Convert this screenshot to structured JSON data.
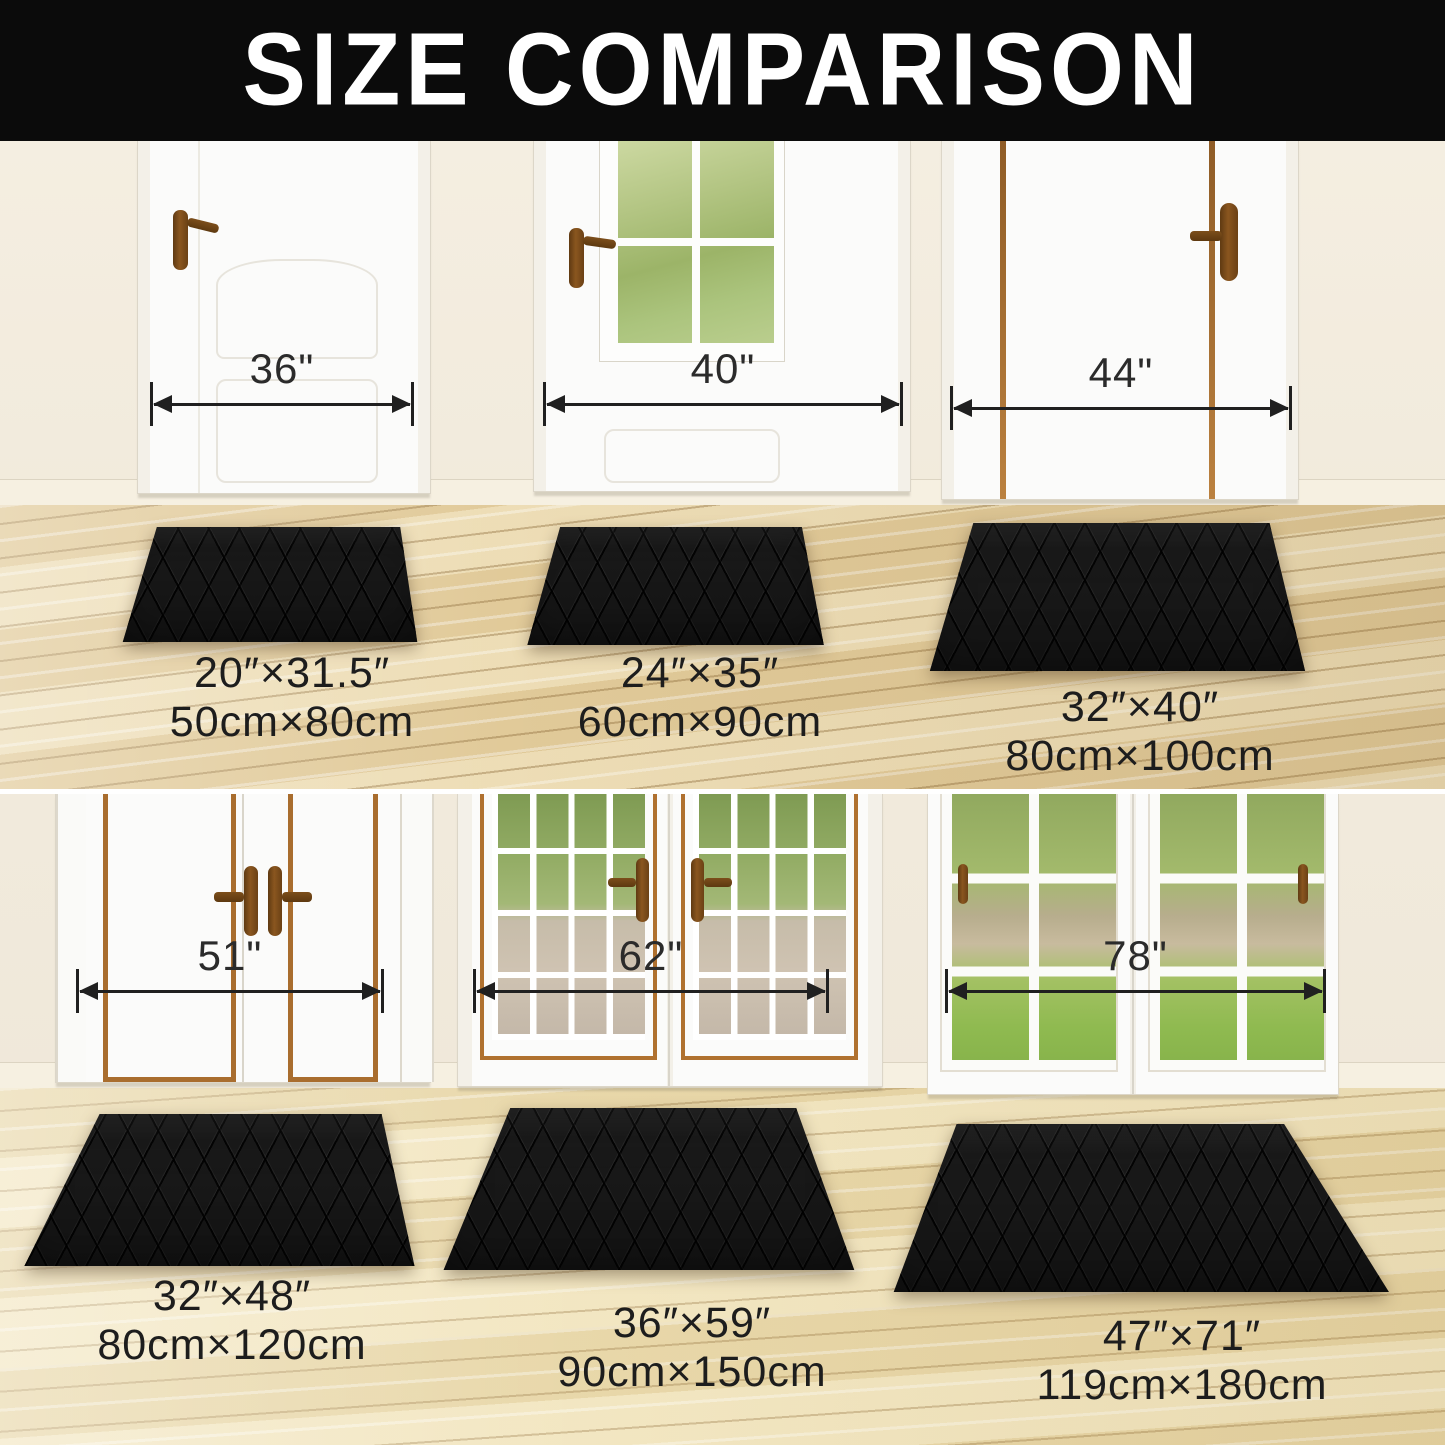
{
  "title": "SIZE COMPARISON",
  "top": {
    "door_widths": [
      "36\"",
      "40\"",
      "44\""
    ],
    "mats": [
      {
        "inches": "20″×31.5″",
        "cm": "50cm×80cm"
      },
      {
        "inches": "24″×35″",
        "cm": "60cm×90cm"
      },
      {
        "inches": "32″×40″",
        "cm": "80cm×100cm"
      }
    ]
  },
  "bottom": {
    "door_widths": [
      "51\"",
      "62\"",
      "78\""
    ],
    "mats": [
      {
        "inches": "32″×48″",
        "cm": "80cm×120cm"
      },
      {
        "inches": "36″×59″",
        "cm": "90cm×150cm"
      },
      {
        "inches": "47″×71″",
        "cm": "119cm×180cm"
      }
    ]
  },
  "colors": {
    "banner": "#0b0b0b",
    "mat": "#1a1a1a",
    "arrow": "#202020",
    "door_handle": "#7c4e1b",
    "door_trim": "#a96d2e",
    "wall": "#f2ebdd",
    "floor": "#e8d5a9"
  }
}
